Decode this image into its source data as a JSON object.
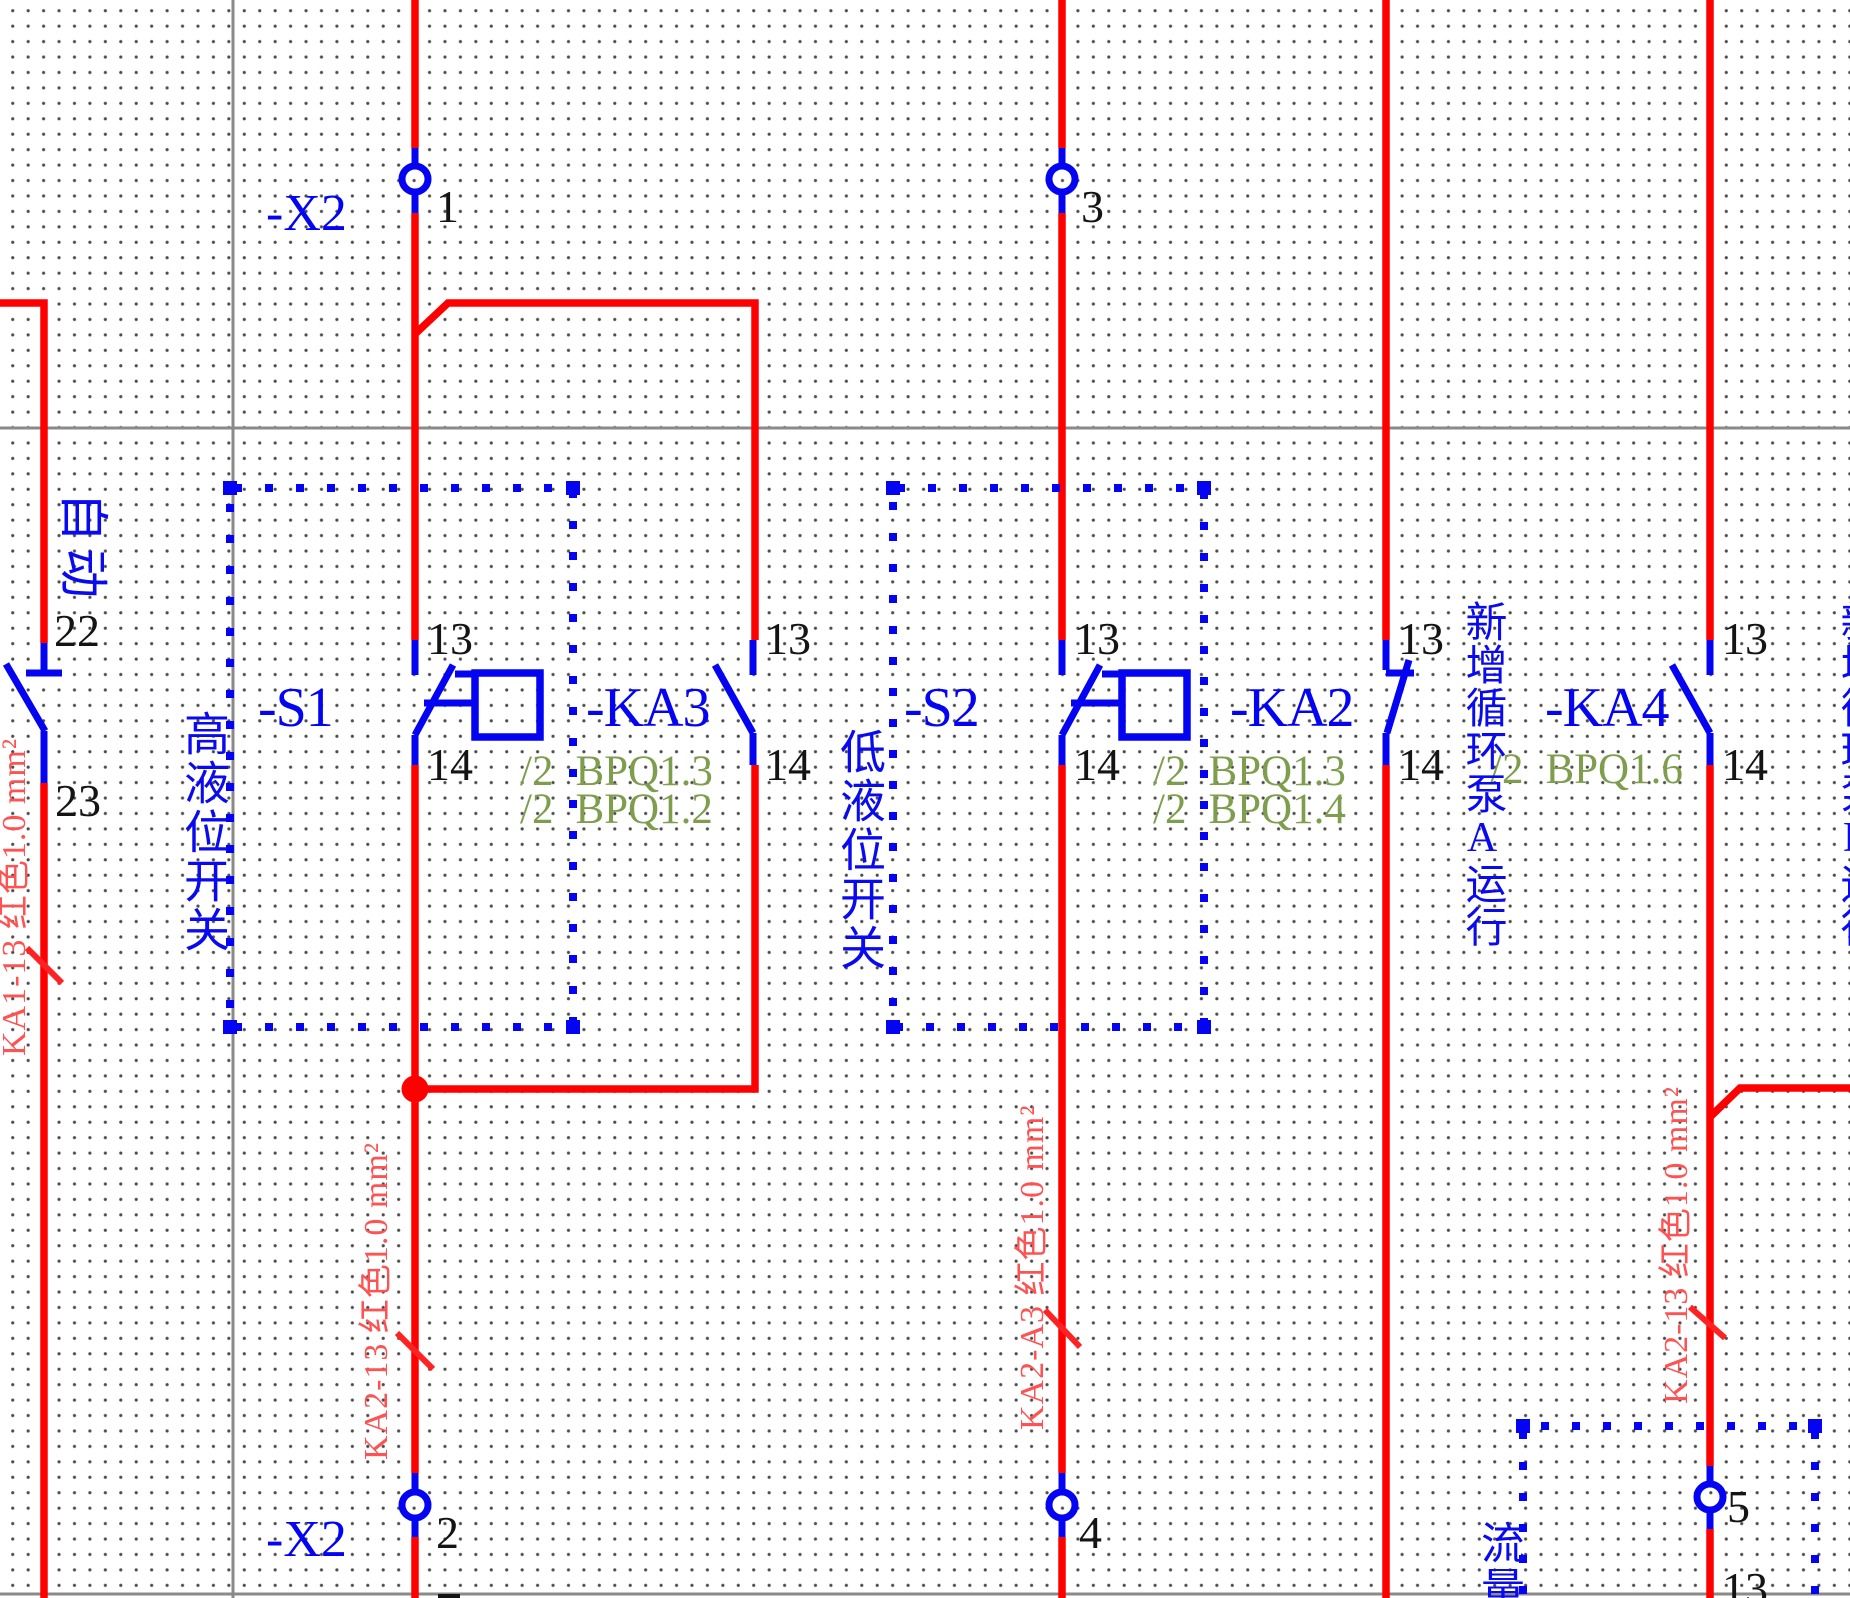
{
  "colors": {
    "wire": "#ff0000",
    "symbol": "#0404f2",
    "reference_text": "#7e9e4e",
    "wire_label_text": "#ff5353",
    "pin_number_text": "#141414",
    "frame_line": "#8a8a8a"
  },
  "terminal_strip": {
    "name_top": "-X2",
    "name_bottom": "-X2",
    "top_terminals": [
      {
        "num": "1"
      },
      {
        "num": "3"
      }
    ],
    "bottom_terminals": [
      {
        "num": "2"
      },
      {
        "num": "4"
      },
      {
        "num": "5"
      }
    ]
  },
  "devices": {
    "ka1_aux": {
      "pin_top": "22",
      "pin_bottom": "23"
    },
    "s1": {
      "label": "-S1",
      "pin_top": "13",
      "pin_bottom": "14"
    },
    "ka3": {
      "label": "-KA3",
      "pin_top": "13",
      "pin_bottom": "14",
      "xrefs": [
        {
          "sheet": "/2",
          "address": "BPQ1.3"
        },
        {
          "sheet": "/2",
          "address": "BPQ1.2"
        }
      ]
    },
    "s2": {
      "label": "-S2",
      "pin_top": "13",
      "pin_bottom": "14"
    },
    "ka2": {
      "label": "-KA2",
      "pin_top": "13",
      "pin_bottom": "14",
      "xrefs": [
        {
          "sheet": "/2",
          "address": "BPQ1.3"
        },
        {
          "sheet": "/2",
          "address": "BPQ1.4"
        }
      ]
    },
    "ka4": {
      "label": "-KA4",
      "pin_top": "13",
      "pin_bottom": "14",
      "xrefs": [
        {
          "sheet": "/2",
          "address": "BPQ1.6"
        }
      ]
    },
    "flow_contact": {
      "pin_top": "13"
    }
  },
  "annotations": {
    "mode": "自动",
    "high_level_switch": "高液位开关",
    "low_level_switch": "低液位开关",
    "pump_a_running": "新增循环泵A运行",
    "pump_b_running": "新增循环泵B运行",
    "flow": "流量"
  },
  "wire_labels": {
    "left_feed": "KA1-13 红色1.0 mm²",
    "x2_2_wire": "KA2-13 红色1.0 mm²",
    "x2_4_wire": "KA2-A3 红色1.0 mm²",
    "x2_5_wire": "KA2-13 红色1.0 mm²"
  }
}
